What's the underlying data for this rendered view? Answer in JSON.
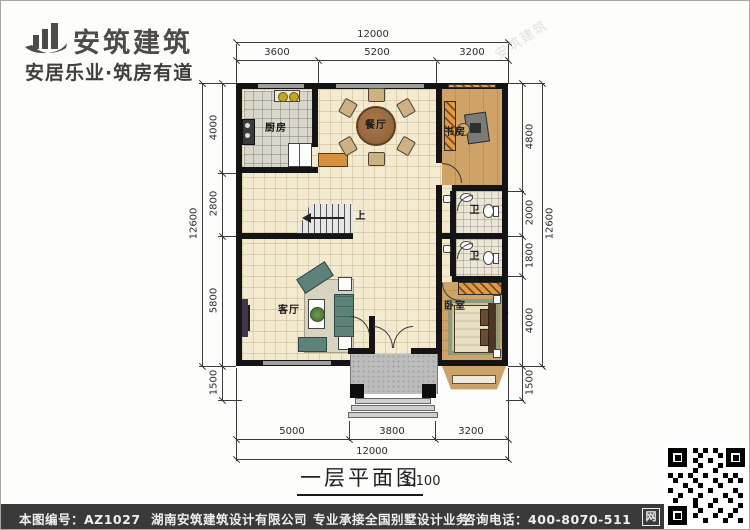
{
  "brand": {
    "name": "安筑建筑",
    "tagline": "安居乐业·筑房有道",
    "logo_icon": "building-logo-icon"
  },
  "plan": {
    "title": "一层平面图",
    "scale_label": "1:100",
    "stairs_up": "上",
    "rooms": {
      "kitchen": "厨房",
      "dining": "餐厅",
      "study": "书房",
      "living": "客厅",
      "bedroom": "卧室",
      "bath1": "卫",
      "bath2": "卫"
    },
    "dims": {
      "top_total": "12000",
      "top": [
        "3600",
        "5200",
        "3200"
      ],
      "bottom": [
        "5000",
        "3800",
        "3200"
      ],
      "bottom_total": "12000",
      "left_total": "12600",
      "left": [
        "4000",
        "2800",
        "5800",
        "1500"
      ],
      "right": [
        "4800",
        "2000",
        "1800",
        "4000",
        "1500"
      ],
      "right_total": "12600"
    }
  },
  "watermark": {
    "text": "安筑建筑"
  },
  "footer": {
    "code": "本图编号：AZ1027",
    "company": "湖南安筑建筑设计有限公司",
    "service": "专业承接全国别墅设计业务",
    "phone": "咨询电话：400-8070-511",
    "badge": "网",
    "qr_icon": "qr-code-icon"
  },
  "colors": {
    "wall": "#141414",
    "floor_cream": "#f4ead0",
    "wood": "#cfa267",
    "tile_grey": "#d9d6ca",
    "accent_orange": "#d6903e",
    "sofa_teal": "#5d8279",
    "footer_bg": "#3a3a3a"
  }
}
